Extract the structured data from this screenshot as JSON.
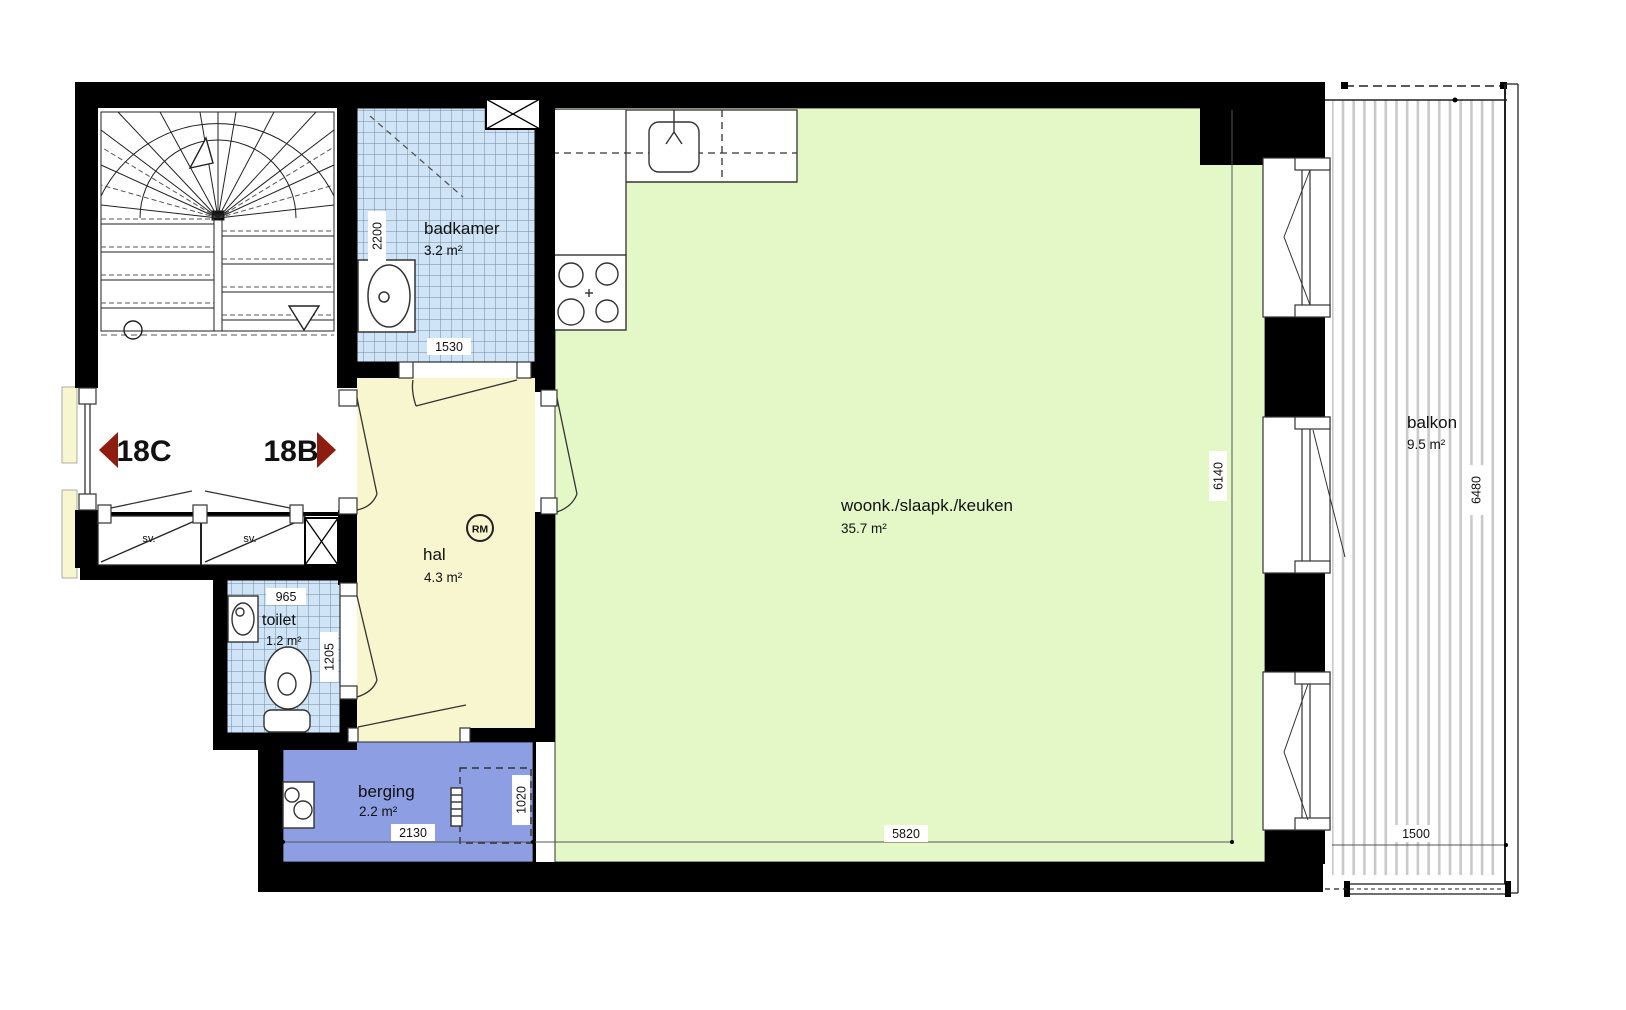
{
  "plan": {
    "rooms": {
      "badkamer": {
        "name": "badkamer",
        "area": "3.2 m²"
      },
      "hal": {
        "name": "hal",
        "area": "4.3 m²"
      },
      "toilet": {
        "name": "toilet",
        "area": "1.2 m²"
      },
      "berging": {
        "name": "berging",
        "area": "2.2 m²"
      },
      "living": {
        "name": "woonk./slaapk./keuken",
        "area": "35.7 m²"
      },
      "balkon": {
        "name": "balkon",
        "area": "9.5 m²"
      }
    },
    "units": {
      "left": "18C",
      "right": "18B"
    },
    "closets": {
      "left": "sv.",
      "right": "sv."
    },
    "symbols": {
      "rm": "RM"
    },
    "dimensions": {
      "badkamer_depth": "2200",
      "badkamer_width": "1530",
      "toilet_width": "965",
      "toilet_depth": "1205",
      "berging_width": "2130",
      "berging_depth": "1020",
      "living_width": "5820",
      "living_depth": "6140",
      "balkon_depth": "6480",
      "balkon_width": "1500"
    },
    "colors": {
      "living": "#e4f7c6",
      "hall": "#f8f6cf",
      "tile": "#cfe4f6",
      "storage": "#8d9ee3",
      "unit_arrow": "#8e1c10",
      "wall": "#000000"
    }
  }
}
